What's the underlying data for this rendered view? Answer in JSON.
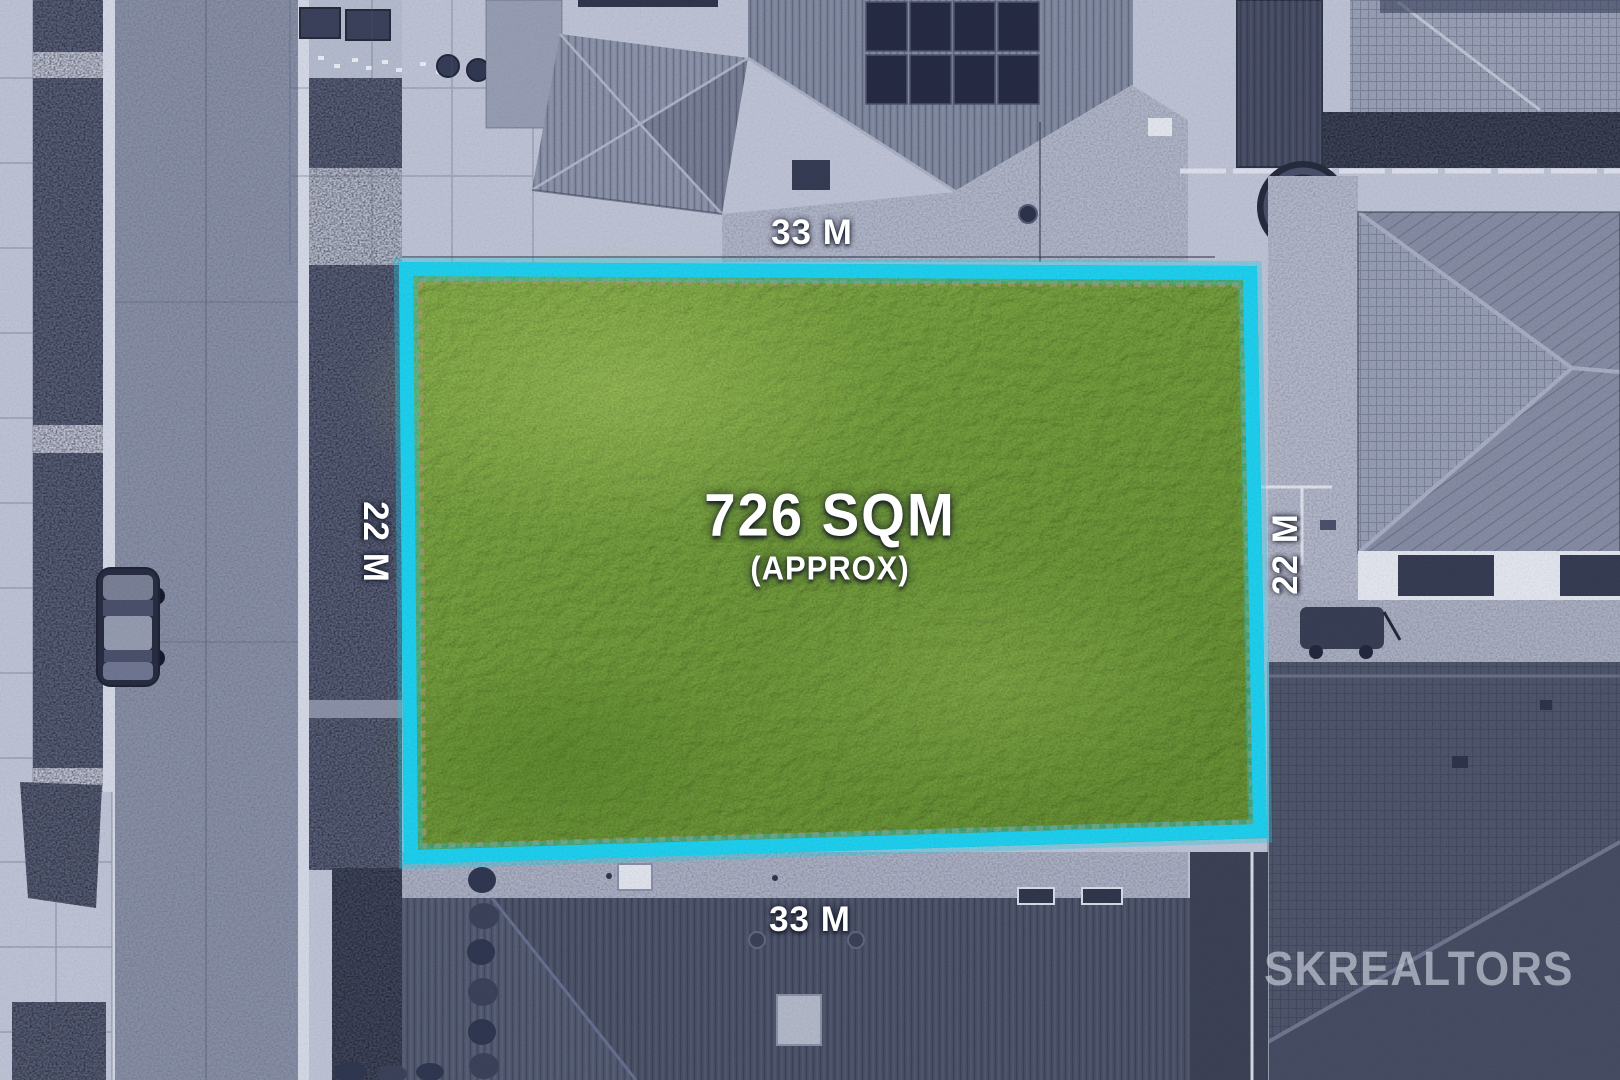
{
  "lot": {
    "area_label": "726 SQM",
    "area_qualifier": "(APPROX)",
    "dimensions": {
      "top": "33 M",
      "bottom": "33 M",
      "left": "22 M",
      "right": "22 M"
    },
    "boundary_color": "#1bd4f2",
    "grass_color": "#78a63a"
  },
  "watermark": {
    "brand": "SKREALTORS",
    "color": "#cbd0dc"
  },
  "photo": {
    "road_color": "#8a92a8",
    "concrete_color": "#c2c7d8",
    "roof_dark_color": "#4b5268",
    "label_color": "#ffffff"
  }
}
